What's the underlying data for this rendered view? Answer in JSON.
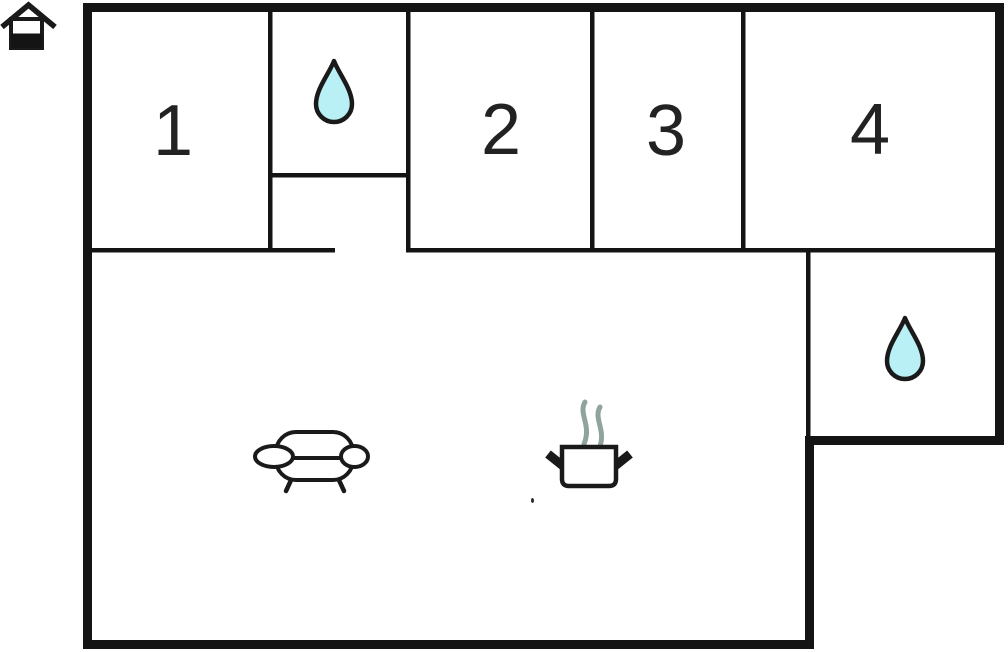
{
  "page": {
    "type": "floor-plan"
  },
  "colors": {
    "background": "#ffffff",
    "wall": "#141414",
    "icon_stroke": "#1a1a1a",
    "water_fill": "#b9f0f5",
    "steam": "#8fa39f",
    "label": "#222222"
  },
  "rooms": [
    {
      "id": "room-1",
      "label": "1"
    },
    {
      "id": "room-2",
      "label": "2"
    },
    {
      "id": "room-3",
      "label": "3"
    },
    {
      "id": "room-4",
      "label": "4"
    }
  ],
  "icons": {
    "logo": "house-icon",
    "top_bathroom": "water-drop-icon",
    "right_bathroom": "water-drop-icon",
    "living_room": "sofa-icon",
    "kitchen": "cooking-pot-icon"
  }
}
